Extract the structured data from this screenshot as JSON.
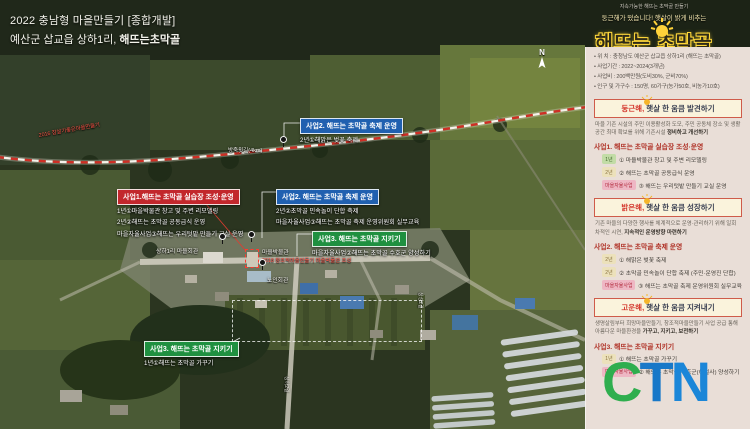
{
  "title": {
    "line1": "2022 충남형 마을만들기 [종합개발]",
    "line2_prefix": "예산군 삽교읍 상하1리, ",
    "line2_bold": "해뜨는초막골"
  },
  "logo": {
    "tagline_small": "지속가능한 해뜨는 초막골 만들기",
    "tagline": "둥근해가 떴습니다! 햇살이 밝게 비추는",
    "name": "해뜨는 초막골"
  },
  "info": {
    "items": [
      "위 치 : 충청남도 예산군 삽교읍 상하1리 (해뜨는 초막골)",
      "사업기간 : 2022~2024(3개년)",
      "사업비 : 200백만원(도비30%, 군비70%)",
      "인구 및 가구수 : 150명, 60가구(농가50호, 비농가10호)"
    ]
  },
  "sections": [
    {
      "title_red": "둥근해,",
      "title_rest": " 햇살 한 움큼 발견하기",
      "desc": "마을 기존 시설의 주민 이용활성화 도모, 주민 공동체 장소 및 생활공간 최대 확보를 위해 기존시설 ",
      "desc_bold": "정비하고 개선하기",
      "subtitle": "사업1. 해뜨는 초막골 실습장 조성·운영",
      "items": [
        {
          "tag": "1년",
          "label": "① 마을박물관 창고 및 주변 리모델링"
        },
        {
          "tag": "2년",
          "label": "② 해뜨는 초막골 공동급식 운영"
        },
        {
          "tag": "마을자율사업",
          "label": "③ 해뜨는 우리텃밭 만들기 교실 운영"
        }
      ]
    },
    {
      "title_red": "밝은해,",
      "title_rest": " 햇살 한 움큼 성장하기",
      "desc": "기존 마을의 다양한 행사를 체계적으로 운영·관리하기 위해 일회차적인 시연, ",
      "desc_bold": "지속적인 운영방향 마련하기",
      "subtitle": "사업2. 해뜨는 초막골 축제 운영",
      "items": [
        {
          "tag": "2년",
          "label": "① 해맑은 벚꽃 축제"
        },
        {
          "tag": "2년",
          "label": "② 초막골 민속놀이 단합 축제 (주민·운영진 단합)"
        },
        {
          "tag": "마을자율사업",
          "label": "③ 해뜨는 초막골 축제 운영위원회 실무교육"
        }
      ]
    },
    {
      "title_red": "고운해,",
      "title_rest": " 햇살 한 움큼 지켜내기",
      "desc": "생명살림부터 희망마을만들기, 창조적마을만들기 사업 공급 통해 아름다운 마을환경을 ",
      "desc_bold": "가꾸고, 지키고, 보전하기",
      "subtitle": "사업3. 해뜨는 초막골 지키기",
      "items": [
        {
          "tag": "1년",
          "label": "① 해뜨는 초막골 가꾸기"
        },
        {
          "tag": "마을자율사업",
          "label": "② 해뜨는 초막골 수호군(해설사) 양성하기"
        }
      ]
    }
  ],
  "map": {
    "compass": "N",
    "route_label": "2016 참살기좋은마을만들기",
    "road_label": "방죽윗길(4km)",
    "poi": {
      "hall": "상하1리 마을회관",
      "museum": "마을박물관",
      "museum_note": "2018 창조적마을만들기 마을박물관 조성",
      "senior": "노인회관"
    },
    "road_small": [
      "상성2길",
      "상하2길"
    ],
    "annotations": [
      {
        "title": "사업2. 해뜨는 초막골 축제 운영",
        "lines": [
          "2년①해맑은 벚꽃 축제"
        ]
      },
      {
        "title": "사업1.해뜨는 초막골 실습장 조성·운영",
        "lines": [
          "1년①마을박물관 창고 및 주변 리모델링",
          "2년②해뜨는 초막골 공동급식 운영",
          "마을자율사업③해뜨는 우리텃밭 만들기 교실 운영"
        ]
      },
      {
        "title": "사업2. 해뜨는 초막골 축제 운영",
        "lines": [
          "2년②초막골 민속놀이 단합 축제",
          "마을자율사업③해뜨는 초막골 축제 운영위원회 실무교육"
        ]
      },
      {
        "title": "사업3. 해뜨는 초막골 지키기",
        "lines": [
          "마을자율사업②해뜨는 초막골 수호군 양성하기"
        ]
      },
      {
        "title": "사업3. 해뜨는 초막골 지키기",
        "lines": [
          "1년①해뜨는 초막골 가꾸기"
        ]
      }
    ]
  },
  "watermark": {
    "c": "C",
    "t": "T",
    "n": "N"
  },
  "colors": {
    "callout_blue": "#2060b0",
    "callout_red": "#c2272c",
    "callout_green": "#1f9040",
    "logo_yellow": "#ffd23a",
    "sidebar_bg": "#e9ded7",
    "ctn_green": "#2fae4e",
    "ctn_blue": "#1878c8"
  }
}
